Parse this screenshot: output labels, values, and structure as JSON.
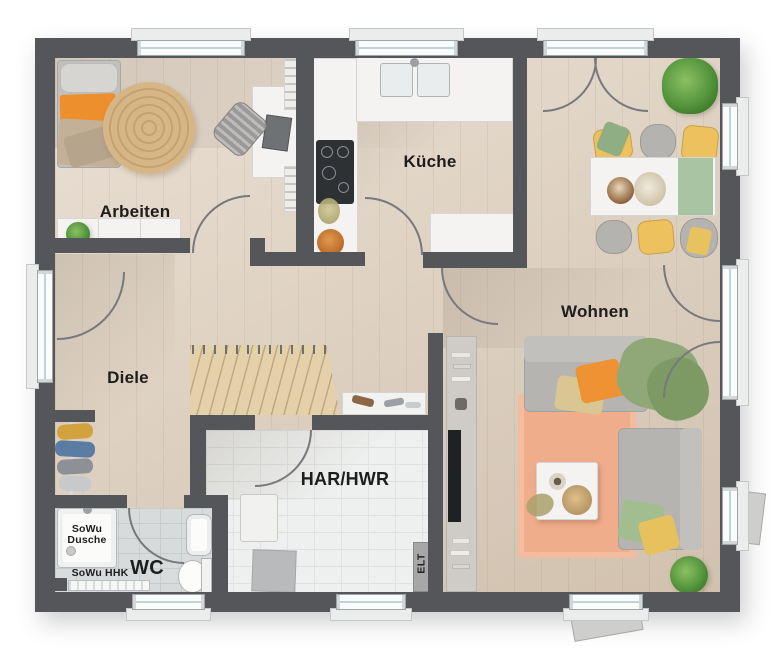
{
  "plan": {
    "type": "floor-plan",
    "rooms": {
      "arbeiten": {
        "label": "Arbeiten"
      },
      "kueche": {
        "label": "Küche"
      },
      "wohnen": {
        "label": "Wohnen"
      },
      "diele": {
        "label": "Diele"
      },
      "har_hwr": {
        "label": "HAR/HWR"
      },
      "wc": {
        "label": "WC"
      }
    },
    "annotations": {
      "shower_line1": "SoWu",
      "shower_line2": "Dusche",
      "heater": "SoWu HHK",
      "electrical": "ELT"
    },
    "fixtures": {
      "arbeiten": [
        "daybed",
        "orange-pillow",
        "jute-rug",
        "desk",
        "laptop",
        "desk-chair",
        "bookshelves",
        "sideboard",
        "plant"
      ],
      "kueche": [
        "counter-l-shape",
        "double-sink",
        "cooktop",
        "fruit-bowl",
        "island-counter"
      ],
      "dining": [
        "dining-table",
        "green-runner",
        "bowl",
        "flowers",
        "yellow-chairs",
        "grey-chairs",
        "palm-plant"
      ],
      "wohnen": [
        "sofa-horizontal",
        "sofa-vertical",
        "orange-pillow",
        "green-throw",
        "peach-rug",
        "coffee-table",
        "tv-sideboard",
        "plant"
      ],
      "diele": [
        "entrance-door",
        "coat-rack",
        "staircase",
        "shoe-shelf"
      ],
      "har_hwr": [
        "water-heater",
        "appliance-box",
        "electrical-panel"
      ],
      "wc": [
        "shower",
        "towel-radiator",
        "washbasin",
        "toilet"
      ]
    },
    "colors": {
      "wall": "#54565a",
      "floor_wood": "#e0d2c1",
      "tile_white": "#eef0ef",
      "tile_grey": "#d8dbdc",
      "counter_white": "#f4f3f1",
      "accent_orange": "#ee8f2e",
      "accent_yellow": "#e8c25f",
      "accent_green": "#8fae83",
      "rug_peach": "#f0ad8b",
      "rug_jute": "#d3b384",
      "stair_wood": "#e4d1a9"
    }
  }
}
